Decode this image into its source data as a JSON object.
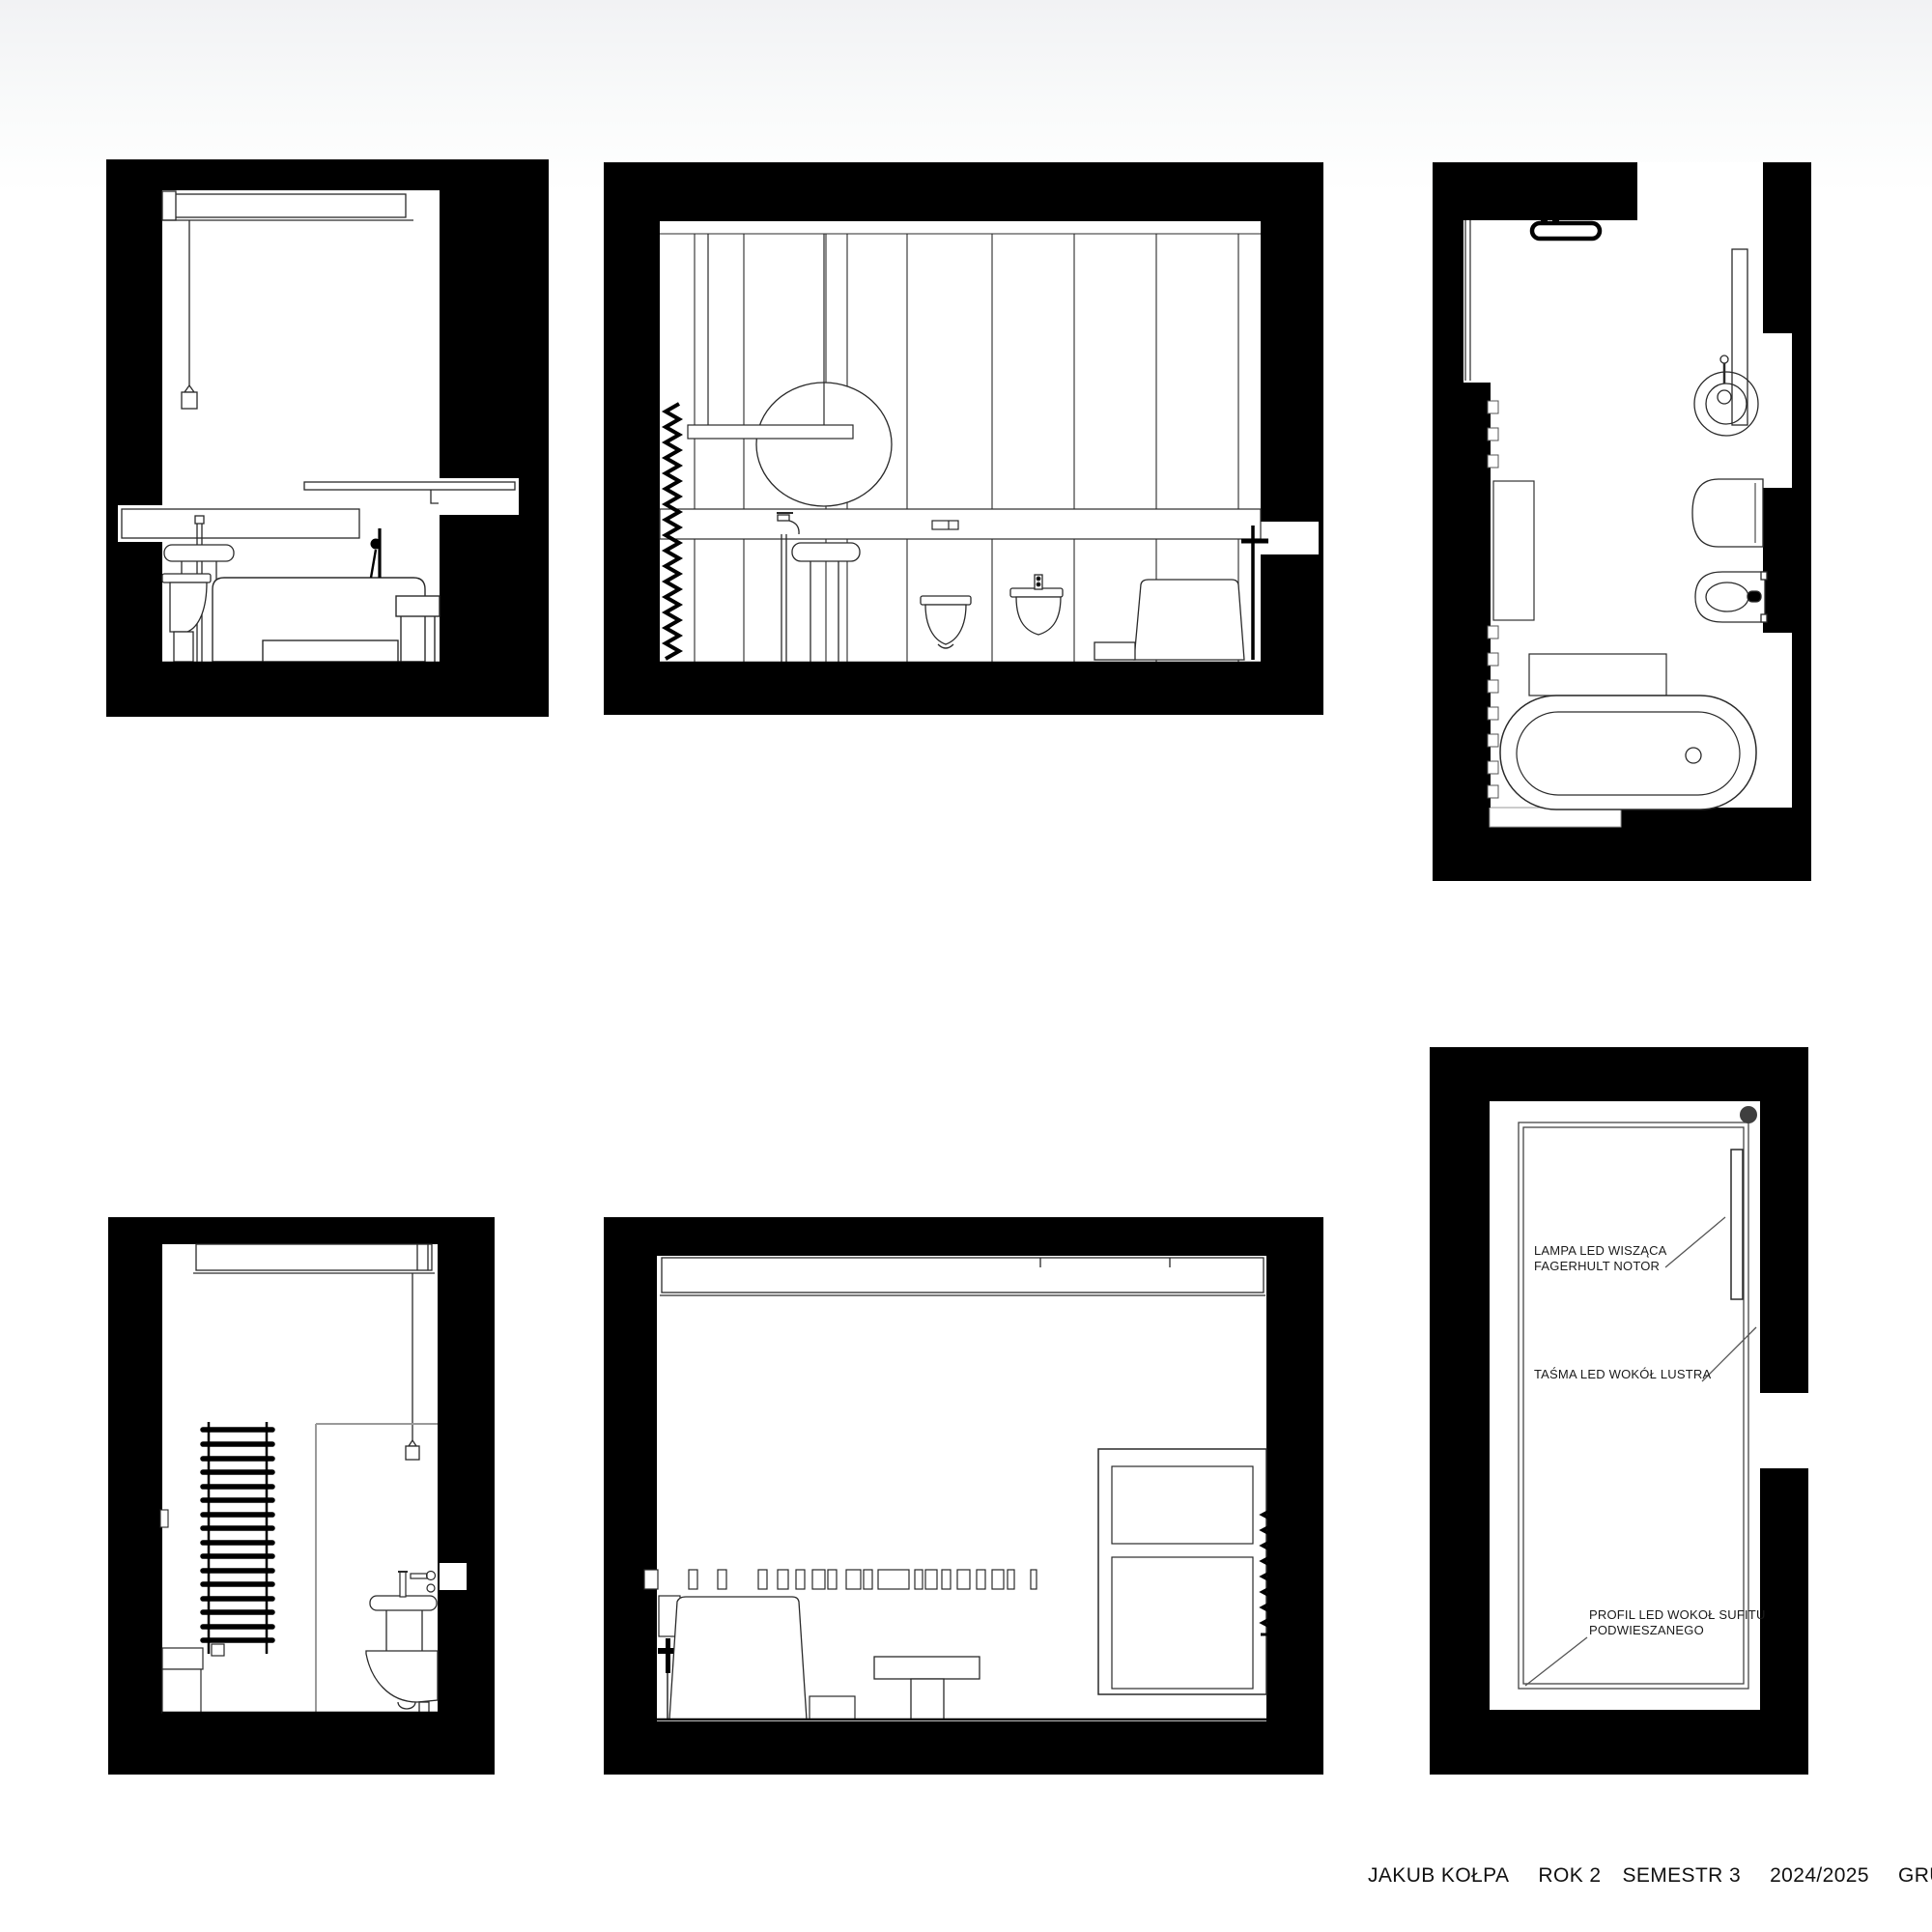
{
  "colors": {
    "ink": "#000000",
    "drawing_line": "#2a2a2a",
    "glass_line": "#9a9a9a",
    "paper": "#ffffff",
    "ceiling_dot": "#3f3f3f"
  },
  "annotations": {
    "lamp_line1": "LAMPA LED WISZĄCA",
    "lamp_line2": "FAGERHULT NOTOR",
    "mirror_tape": "TAŚMA LED WOKÓŁ LUSTRA",
    "ceiling_profile_line1": "PROFIL LED WOKOŁ SUFITU",
    "ceiling_profile_line2": "PODWIESZANEGO"
  },
  "footer": {
    "author": "JAKUB KOŁPA",
    "year": "ROK 2",
    "semester": "SEMESTR 3",
    "academic_year": "2024/2025",
    "group": "GRUPA AM"
  }
}
